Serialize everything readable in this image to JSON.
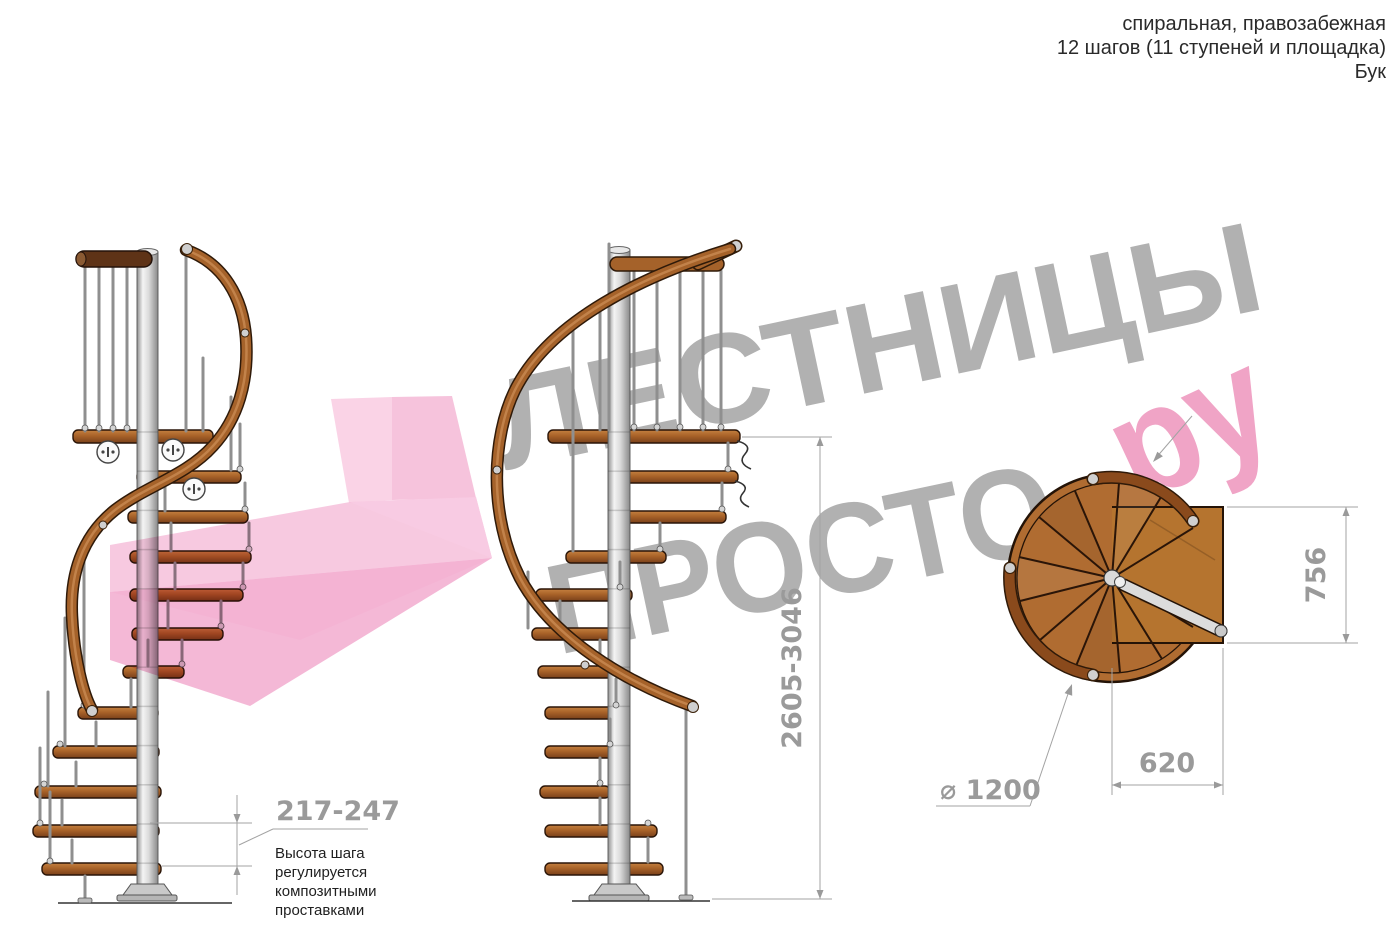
{
  "header": {
    "line1": "спиральная, правозабежная",
    "line2": "12 шагов (11 ступеней и площадка)",
    "line3": "Бук"
  },
  "watermark": {
    "line1": "ЛЕСТНИЦЫ",
    "line2": "ПРОСТО",
    "suffix": "ру"
  },
  "dimensions": {
    "step_height": "217-247",
    "step_note_line1": "Высота шага",
    "step_note_line2": "регулируется",
    "step_note_line3": "композитными",
    "step_note_line4": "проставками",
    "total_height": "2605-3046",
    "landing_depth": "756",
    "landing_width": "620",
    "diameter": "⌀ 1200"
  },
  "colors": {
    "wood": "#a5622a",
    "wood_dark": "#2a1508",
    "pole": "#d6d6d6",
    "dimension_gray": "#9a9a9a",
    "watermark_gray": "#b1b1b1",
    "pink_light": "#f9cde4",
    "pink_mid": "#f5bad8",
    "pink_deep": "#f1a9ce",
    "pink_accent": "#e0557f",
    "pink_text": "#f0a4c6"
  }
}
